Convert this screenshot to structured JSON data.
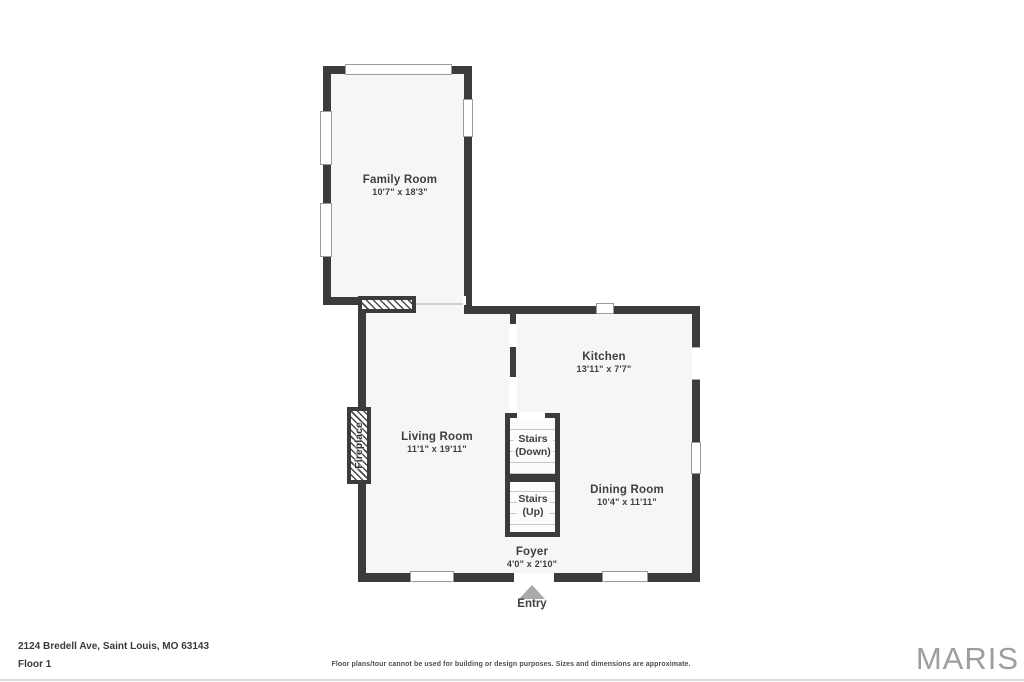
{
  "rooms": {
    "family_room": {
      "name": "Family Room",
      "dims": "10'7\" x 18'3\""
    },
    "living_room": {
      "name": "Living Room",
      "dims": "11'1\" x 19'11\""
    },
    "kitchen": {
      "name": "Kitchen",
      "dims": "13'11\" x 7'7\""
    },
    "dining_room": {
      "name": "Dining Room",
      "dims": "10'4\" x 11'11\""
    },
    "foyer": {
      "name": "Foyer",
      "dims": "4'0\" x 2'10\""
    }
  },
  "stairs": {
    "down": {
      "line1": "Stairs",
      "line2": "(Down)"
    },
    "up": {
      "line1": "Stairs",
      "line2": "(Up)"
    }
  },
  "fireplace_label": "Fireplace",
  "entry_label": "Entry",
  "footer": {
    "address": "2124 Bredell Ave, Saint Louis, MO 63143",
    "floor": "Floor 1",
    "disclaimer": "Floor plans/tour cannot be used for building or design purposes. Sizes and dimensions are approximate.",
    "logo": "MARIS"
  },
  "colors": {
    "wall": "#3b3b3b",
    "floor": "#f6f6f6",
    "window_frame": "#9b9b9b",
    "entry_arrow": "#a9a9a9",
    "logo_gray": "#9e9e9e",
    "label_text": "#3f3f3f"
  }
}
